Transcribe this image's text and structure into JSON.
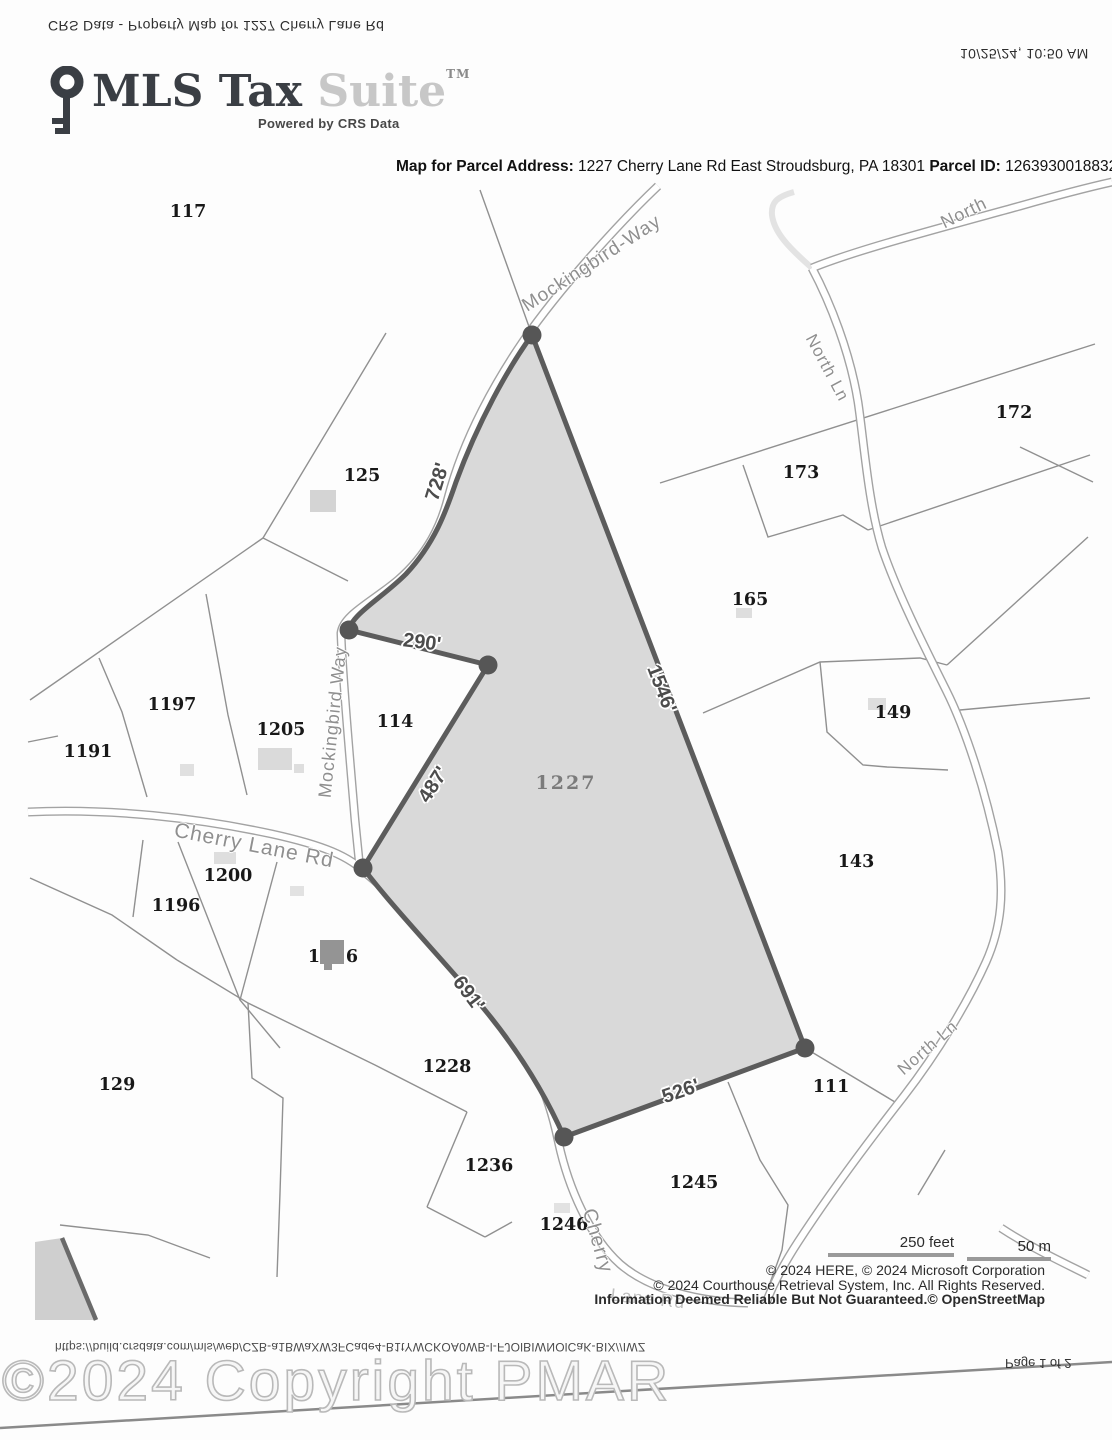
{
  "page": {
    "header_flipped_left": "CRS Data - Property Map for 1227 Cherry Lane Rd",
    "header_flipped_right": "10/25/24, 10:50 AM",
    "footer_flipped_url": "https://build.crsdata.com/mls/web/CZB-a1BWaXW3FCade4-B1tYWCKOA0WB-l-FJOlBIWNOlCaK-BIX//IWZ",
    "footer_flipped_page": "Page 1 of 2",
    "watermark": "©2024 Copyright PMAR"
  },
  "logo": {
    "brand_primary": "MLS Tax",
    "brand_secondary": "Suite",
    "trademark": "TM",
    "tagline": "Powered by CRS Data",
    "key_icon": "key-icon"
  },
  "title": {
    "address_label": "Map for Parcel Address:",
    "address_value": "1227 Cherry Lane Rd East Stroudsburg, PA 18301",
    "parcel_id_label": "Parcel ID:",
    "parcel_id_value": "12639300188324"
  },
  "map": {
    "subject_parcel": {
      "label": "1227",
      "fill_color": "#d9d9d9",
      "border_color": "#5c5c5c"
    },
    "dimensions": [
      {
        "text": "728'"
      },
      {
        "text": "290'"
      },
      {
        "text": "1546'"
      },
      {
        "text": "487'"
      },
      {
        "text": "691'"
      },
      {
        "text": "526'"
      }
    ],
    "roads": [
      {
        "name": "Mockingbird-Way"
      },
      {
        "name": "Mockingbird Way"
      },
      {
        "name": "Cherry Lane Rd"
      },
      {
        "name": "Cherry"
      },
      {
        "name": "Lane Rd"
      },
      {
        "name": "North"
      },
      {
        "name": "North Ln"
      },
      {
        "name": "North Ln"
      }
    ],
    "parcels": [
      {
        "label": "117"
      },
      {
        "label": "125"
      },
      {
        "label": "172"
      },
      {
        "label": "173"
      },
      {
        "label": "165"
      },
      {
        "label": "149"
      },
      {
        "label": "143"
      },
      {
        "label": "1197"
      },
      {
        "label": "1205"
      },
      {
        "label": "1191"
      },
      {
        "label": "114"
      },
      {
        "label": "1200"
      },
      {
        "label": "1196"
      },
      {
        "label": "129"
      },
      {
        "label": "1228"
      },
      {
        "label": "111"
      },
      {
        "label": "1236"
      },
      {
        "label": "1245"
      },
      {
        "label": "1246"
      }
    ],
    "split_parcel": {
      "prefix": "1",
      "suffix": "6"
    }
  },
  "legend": {
    "scale_feet": "250 feet",
    "scale_meters": "50 m",
    "copyright_line1": "© 2024 HERE, © 2024 Microsoft Corporation",
    "copyright_line2": "© 2024 Courthouse Retrieval System, Inc. All Rights Reserved.",
    "copyright_line3": "Information Deemed Reliable But Not Guaranteed.© OpenStreetMap"
  }
}
